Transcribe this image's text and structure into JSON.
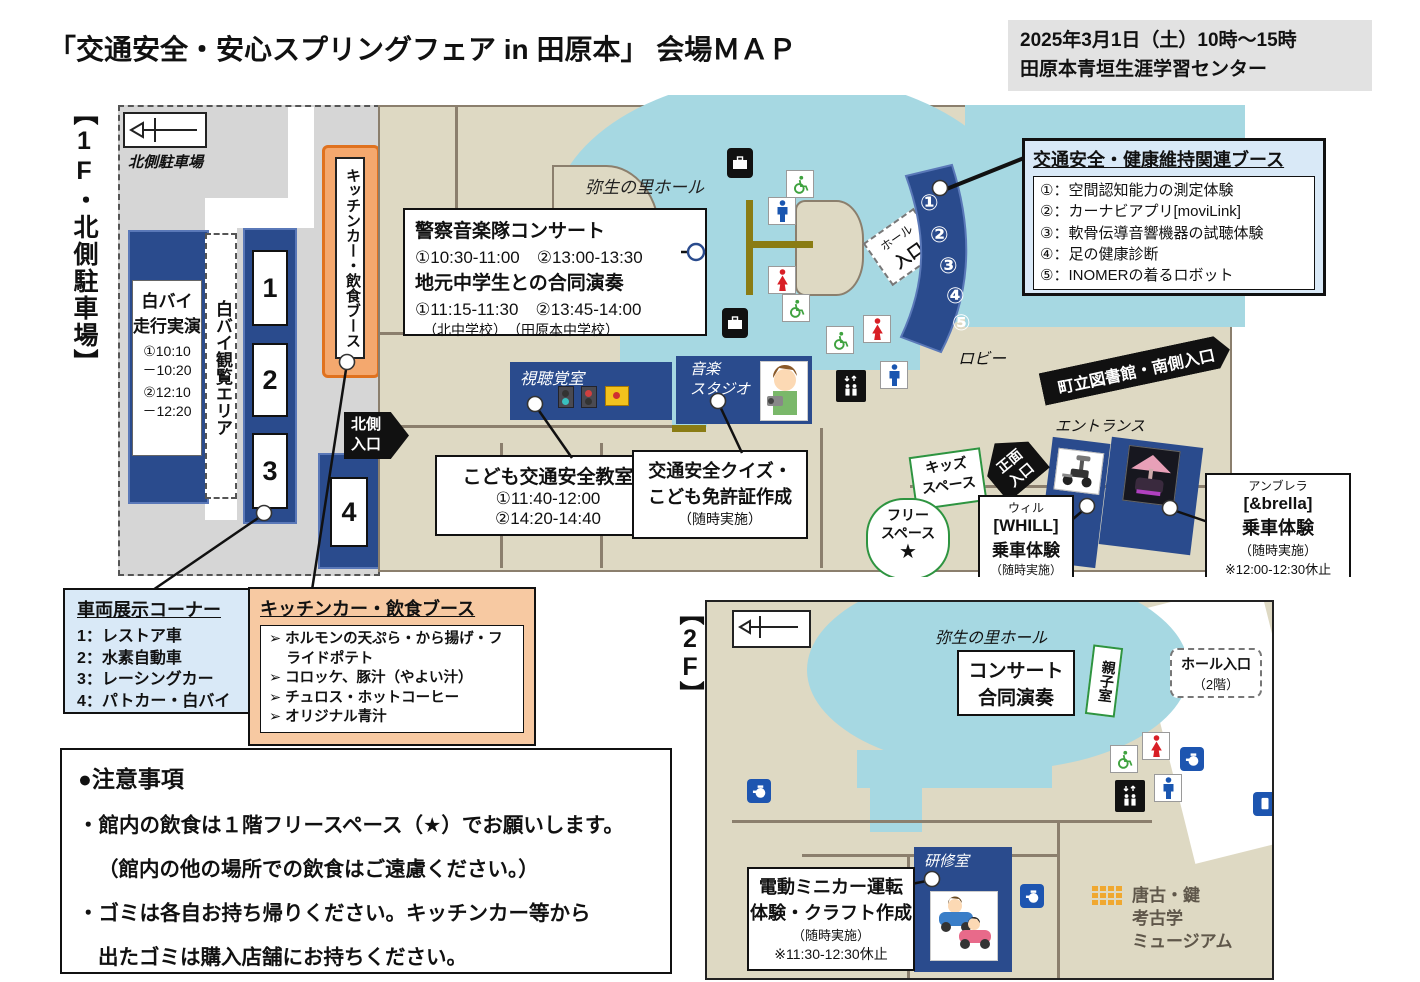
{
  "colors": {
    "navy": "#2a4b8d",
    "hall_blue": "#a6d8e2",
    "floor_beige": "#ded9c3",
    "parking_gray": "#d6d6d6",
    "orange_fill": "#f4a86e",
    "orange_border": "#e0721f",
    "legend_blue": "#d9e9f7",
    "legend_orange": "#f7c9a2",
    "green": "#2e9440",
    "wall_brown": "#8b7f6d"
  },
  "header": {
    "title": "「交通安全・安心スプリングフェア in 田原本」 会場ＭＡＰ",
    "date_line1": "2025年3月1日（土）10時～15時",
    "date_line2": "田原本青垣生涯学習センター"
  },
  "floor1": {
    "section_label": "【1F・北側駐車場】",
    "parking_label": "北側駐車場",
    "hall_label": "弥生の里ホール",
    "lobby_label": "ロビー",
    "hall_entrance_line1": "ホール",
    "hall_entrance_line2": "入口",
    "north_entrance_line1": "北側",
    "north_entrance_line2": "入口",
    "main_entrance_line1": "正面",
    "main_entrance_line2": "入口",
    "entrance_label": "エントランス",
    "library_banner": "町立図書館・南側入口",
    "kids_space_line1": "キッズ",
    "kids_space_line2": "スペース",
    "free_space_line1": "フリー",
    "free_space_line2": "スペース",
    "free_space_star": "★",
    "viewing_area": "白バイ観覧エリア",
    "motorcycle_demo": {
      "title_line1": "白バイ",
      "title_line2": "走行実演",
      "time1a": "①10:10",
      "time1b": "－10:20",
      "time2a": "②12:10",
      "time2b": "－12:20"
    },
    "stand_numbers": [
      "1",
      "2",
      "3",
      "4"
    ],
    "kitchen_booth_vertical": "キッチンカー・飲食ブース",
    "av_room": "視聴覚室",
    "music_studio_line1": "音楽",
    "music_studio_line2": "スタジオ",
    "concert_box": {
      "title1": "警察音楽隊コンサート",
      "times1": "①10:30-11:00　②13:00-13:30",
      "title2": "地元中学生との合同演奏",
      "times2": "①11:15-11:30　②13:45-14:00",
      "schools": "（北中学校）　（田原本中学校）"
    },
    "kids_class_box": {
      "title": "こども交通安全教室",
      "time1": "①11:40-12:00",
      "time2": "②14:20-14:40"
    },
    "quiz_box": {
      "line1": "交通安全クイズ・",
      "line2": "こども免許証作成",
      "line3": "（随時実施）"
    },
    "health_booth": {
      "title": "交通安全・健康維持関連ブース",
      "items": [
        "①：空間認知能力の測定体験",
        "②：カーナビアプリ[moviLink]",
        "③：軟骨伝導音響機器の試聴体験",
        "④：足の健康診断",
        "⑤：INOMERの着るロボット"
      ]
    },
    "booth_numbers": [
      "①",
      "②",
      "③",
      "④",
      "⑤"
    ],
    "whill_box": {
      "line1": "ウィル",
      "line2": "[WHILL]",
      "line3": "乗車体験",
      "line4": "（随時実施）"
    },
    "brella_box": {
      "line1": "アンブレラ",
      "line2": "[&brella]",
      "line3": "乗車体験",
      "line4": "（随時実施）",
      "line5": "※12:00-12:30休止"
    }
  },
  "legends": {
    "vehicle_corner": {
      "title": "車両展示コーナー",
      "items": [
        "1：レストア車",
        "2：水素自動車",
        "3：レーシングカー",
        "4：パトカー・白バイ"
      ]
    },
    "kitchen": {
      "title": "キッチンカー・飲食ブース",
      "items": [
        "➢ ホルモンの天ぷら・から揚げ・フライドポテト",
        "➢ コロッケ、豚汁（やよい汁）",
        "➢ チュロス・ホットコーヒー",
        "➢ オリジナル青汁"
      ]
    }
  },
  "notes": {
    "title": "●注意事項",
    "line1": "・館内の飲食は１階フリースペース（★）でお願いします。",
    "line2": "（館内の他の場所での飲食はご遠慮ください。）",
    "line3": "・ゴミは各自お持ち帰りください。キッチンカー等から",
    "line4": "出たゴミは購入店舗にお持ちください。"
  },
  "floor2": {
    "section_label": "【2F】",
    "hall_label": "弥生の里ホール",
    "concert_box_line1": "コンサート",
    "concert_box_line2": "合同演奏",
    "parent_child_room": "親子室",
    "hall_entrance_line1": "ホール入口",
    "hall_entrance_line2": "（2階）",
    "training_room": "研修室",
    "minicar_box": {
      "line1": "電動ミニカー運転",
      "line2": "体験・クラフト作成",
      "line3": "（随時実施）",
      "line4": "※11:30-12:30休止"
    },
    "museum_line1": "唐古・鍵",
    "museum_line2": "考古学",
    "museum_line3": "ミュージアム"
  }
}
